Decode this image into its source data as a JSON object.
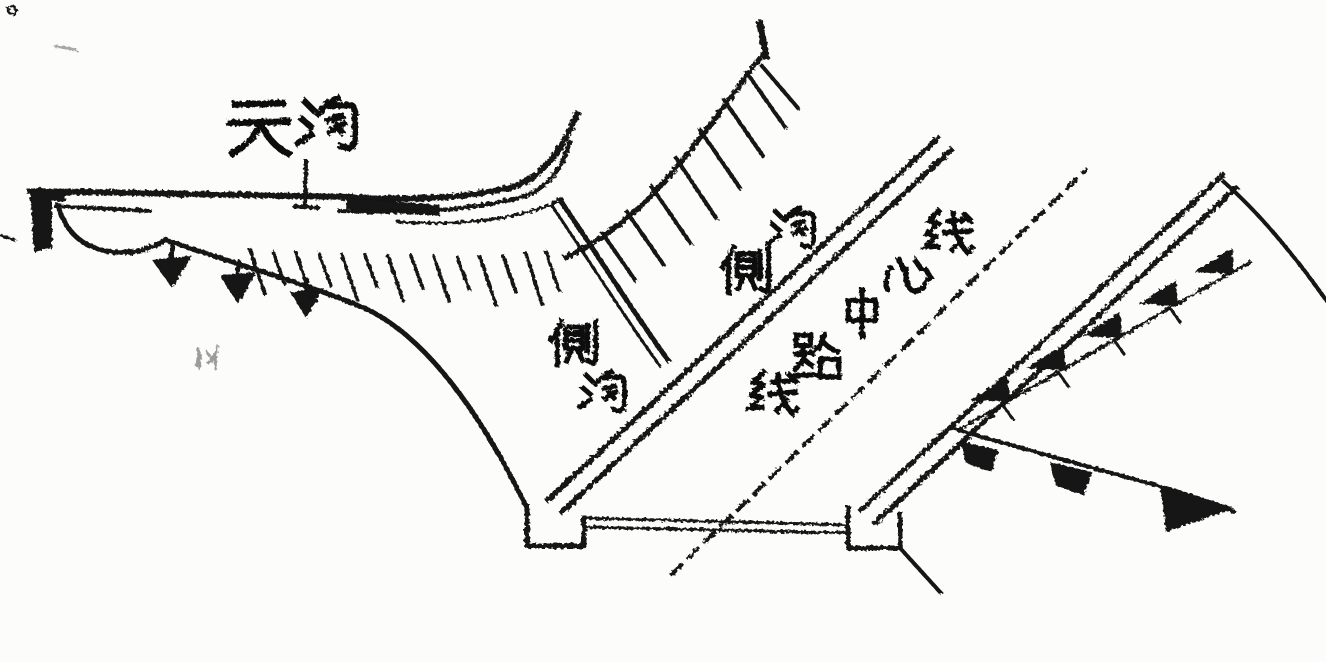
{
  "canvas": {
    "background": "#fcfcfa",
    "ink": "#121212"
  },
  "labels": {
    "tiangou": {
      "text": "天沟"
    },
    "cegou_upper": {
      "text": "侧沟"
    },
    "cegou_lower": {
      "text": "侧沟"
    },
    "centerline": {
      "text": "线路中心线"
    },
    "faint_mark": {
      "text": "似"
    }
  }
}
